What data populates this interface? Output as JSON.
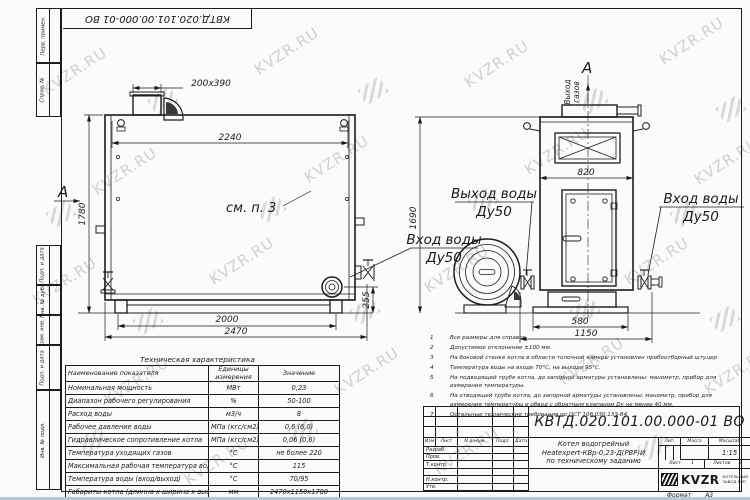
{
  "watermark": {
    "text": "KVZR.RU"
  },
  "frame": {
    "doc_number_top": "КВТД.020.101.00.000-01 ВО",
    "margin_labels": [
      "Перв. примен.",
      "Справ. №",
      "Подп. и дата",
      "Инв. № дубл.",
      "Взам. инв. №",
      "Подп. и дата",
      "Инв. № подл."
    ],
    "format_label": "Формат",
    "format_value": "А3"
  },
  "drawing": {
    "view_arrow_label": "А",
    "section_note": "см. п. 3",
    "gas_outlet_line1": "Выход",
    "gas_outlet_line2": "газов",
    "water_outlet": "Выход воды",
    "water_inlet": "Вход воды",
    "dy": "Ду50",
    "dims": {
      "duct": "200х390",
      "top_width": "2240",
      "left_height": "1780",
      "base_width": "2000",
      "overall_width": "2470",
      "outlet_offset": "255",
      "front_width": "820",
      "front_base": "580",
      "front_overall": "1150",
      "right_height": "1690"
    }
  },
  "notes": {
    "items": [
      {
        "num": "1",
        "text": "Все размеры для справок"
      },
      {
        "num": "2",
        "text": "Допустимое отклонение ±100 мм."
      },
      {
        "num": "3",
        "text": "На боковой стенке котла в области топочной камеры установлен пробоотборный штуцер"
      },
      {
        "num": "4",
        "text": "Температура воды на входе 70°С, на выходе 95°С."
      },
      {
        "num": "5",
        "text": "На подводящей трубе котла, до запорной арматуры установлены: манометр, прибор для измерения температуры."
      },
      {
        "num": "6",
        "text": "На отводящей трубе котла, до запорной арматуры установлены: манометр, прибор для измерения температуры и обвод с обратным клапаном Dу не менее 40 мм."
      },
      {
        "num": "7",
        "text": "Остальные технические требования по ОСТ 108.030.133-84."
      }
    ]
  },
  "spec_table": {
    "title": "Техническая характеристика",
    "col_name": "Наименование показателя",
    "col_units": "Единицы измерения",
    "col_value": "Значение",
    "rows": [
      {
        "name": "Номинальная мощность",
        "units": "МВт",
        "value": "0,23"
      },
      {
        "name": "Диапазон рабочего регулирования",
        "units": "%",
        "value": "50-100"
      },
      {
        "name": "Расход воды",
        "units": "м3/ч",
        "value": "8"
      },
      {
        "name": "Рабочее давление воды",
        "units": "МПа (кгс/см2)",
        "value": "0,6 (6,0)"
      },
      {
        "name": "Гидравлическое сопротивление котла",
        "units": "МПа (кгс/см2)",
        "value": "0,06 (0,6)"
      },
      {
        "name": "Температура уходящих газов",
        "units": "°С",
        "value": "не более 220"
      },
      {
        "name": "Максимальная рабочая температура воды",
        "units": "°С",
        "value": "115"
      },
      {
        "name": "Температура воды (вход/выход)",
        "units": "°С",
        "value": "70/95"
      },
      {
        "name": "Габариты котла (длинна х ширина х высота)",
        "units": "мм",
        "value": "2470х1150х1780"
      }
    ]
  },
  "title_block": {
    "doc_number": "КВТД.020.101.00.000-01 ВО",
    "name_line1": "Котел водогрейный",
    "name_line2": "Heatexpert-КВр-0,23-Д(РВР)И",
    "name_line3": "по техническому заданию",
    "header_cells": [
      "Изм",
      "Лист",
      "N докум.",
      "Подп.",
      "Дата"
    ],
    "row_labels": [
      "Разраб.",
      "Пров.",
      "Т.контр.",
      "Н.контр.",
      "Утв."
    ],
    "lit_label": "Лит.",
    "mass_label": "Масса",
    "scale_label": "Масштаб",
    "scale_value": "1:15",
    "sheet_label": "Лист",
    "sheet_value": "1",
    "sheets_label": "Листов",
    "sheets_value": "2",
    "company_name": "KVZR",
    "company_sub1": "КОТЕЛЬНЫЙ",
    "company_sub2": "ЗАВОД РЭП"
  }
}
